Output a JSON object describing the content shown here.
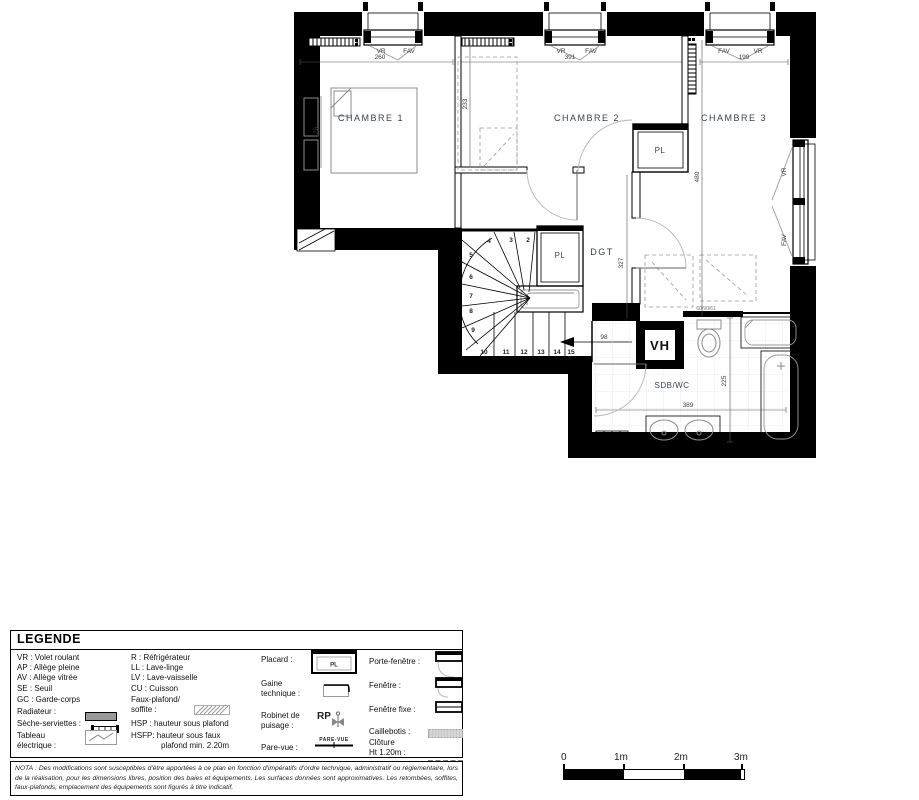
{
  "colors": {
    "wall": "#000000",
    "room_label": "#39424e",
    "dim_text": "#3a3a3a",
    "dashed_gray": "#9a9a9a",
    "fixture_gray": "#8c8c8c",
    "tile_gray": "#dddddd"
  },
  "plan": {
    "labels": {
      "ch1": "CHAMBRE 1",
      "ch2": "CHAMBRE 2",
      "ch3": "CHAMBRE 3",
      "pl1": "PL",
      "pl2": "PL",
      "dgt": "DGT",
      "sdb": "SDB/WC",
      "vh": "VH"
    },
    "win": {
      "w1l": "VR",
      "w1r": "FAV",
      "w1d": "260",
      "w2l": "VR",
      "w2r": "FAV",
      "w2d": "391",
      "w3l": "FAV",
      "w3r": "VR",
      "w3d": "199",
      "rt": "VR",
      "rb": "FAV"
    },
    "dims": {
      "d233": "233",
      "d126": "126",
      "d480": "480",
      "d327": "327",
      "d98": "98",
      "d389": "389",
      "d225": "225",
      "note": "60/90/61"
    },
    "steps": [
      "2",
      "3",
      "4",
      "5",
      "6",
      "7",
      "8",
      "9",
      "10",
      "11",
      "12",
      "13",
      "14",
      "15"
    ]
  },
  "legend": {
    "title": "LEGENDE",
    "col1": [
      "VR : Volet roulant",
      "AP : Allège pleine",
      "AV : Allège vitrée",
      "SE : Seuil",
      "GC : Garde-corps",
      "Radiateur :",
      "Sèche-serviettes :",
      "Tableau",
      "électrique :"
    ],
    "col2": [
      "R : Réfrigérateur",
      "LL : Lave-linge",
      "LV : Lave-vaisselle",
      "CU : Cuisson",
      "Faux-plafond/",
      "soffite :",
      "HSP : hauteur sous plafond",
      "HSFP: hauteur sous faux",
      "plafond min. 2.20m"
    ],
    "col3": {
      "placard": "Placard :",
      "placard_symbol": "PL",
      "gaine1": "Gaine",
      "gaine2": "technique :",
      "robinet1": "Robinet de",
      "robinet2": "puisage :",
      "rp": "RP",
      "parevue": "Pare-vue :",
      "parevue_symbol": "PARE-VUE"
    },
    "col4": {
      "porte": "Porte-fenêtre :",
      "fenetre": "Fenêtre :",
      "fixe": "Fenêtre fixe :",
      "caillebotis": "Caillebotis :",
      "cloture1": "Clôture",
      "cloture2": "Ht 1.20m :"
    }
  },
  "scale_bar": {
    "labels": [
      "0",
      "1m",
      "2m",
      "3m"
    ]
  },
  "nota": "NOTA : Des modifications sont susceptibles d'être apportées à ce plan en fonction d'impératifs d'ordre technique, administratif ou réglementaire, lors de la réalisation, pour les dimensions libres, position des baies et équipements. Les surfaces données sont approximatives. Les retombées, soffites, faux-plafonds, emplacement des équipements sont figurés à titre indicatif."
}
